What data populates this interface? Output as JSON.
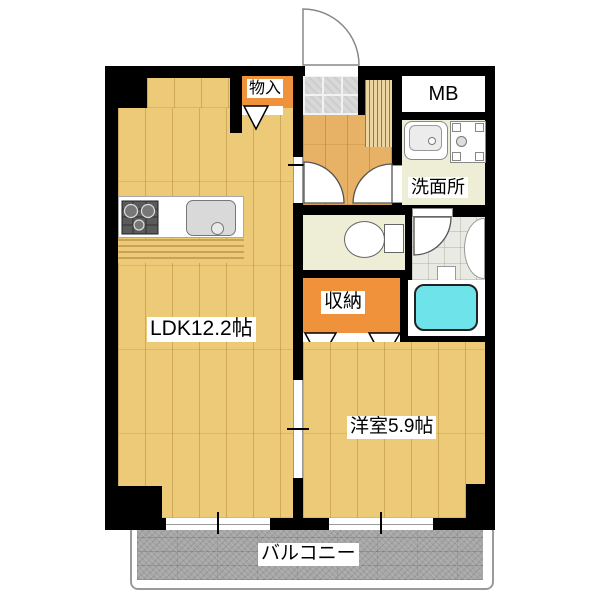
{
  "labels": {
    "storage": "物入",
    "meter_box": "MB",
    "washroom": "洗面所",
    "closet": "収納",
    "ldk": "LDK12.2帖",
    "western_room": "洋室5.9帖",
    "balcony": "バルコニー"
  },
  "colors": {
    "wall": "#000000",
    "wood_floor": "#ecca78",
    "hall_floor": "#e8b266",
    "entrance_tile": "#d8d8d8",
    "accent_orange": "#f0923c",
    "wet_area_floor": "#eeedd6",
    "bath_tile": "#eaeae5",
    "bathtub": "#6fe3ea",
    "balcony_deck": "#a6a6a6"
  },
  "fixtures": [
    "entrance-door",
    "shoe-cabinet",
    "stove",
    "kitchen-sink",
    "vanity-sink",
    "washing-machine-pan",
    "toilet",
    "bathtub",
    "closet-folding-doors",
    "sliding-door",
    "windows"
  ]
}
